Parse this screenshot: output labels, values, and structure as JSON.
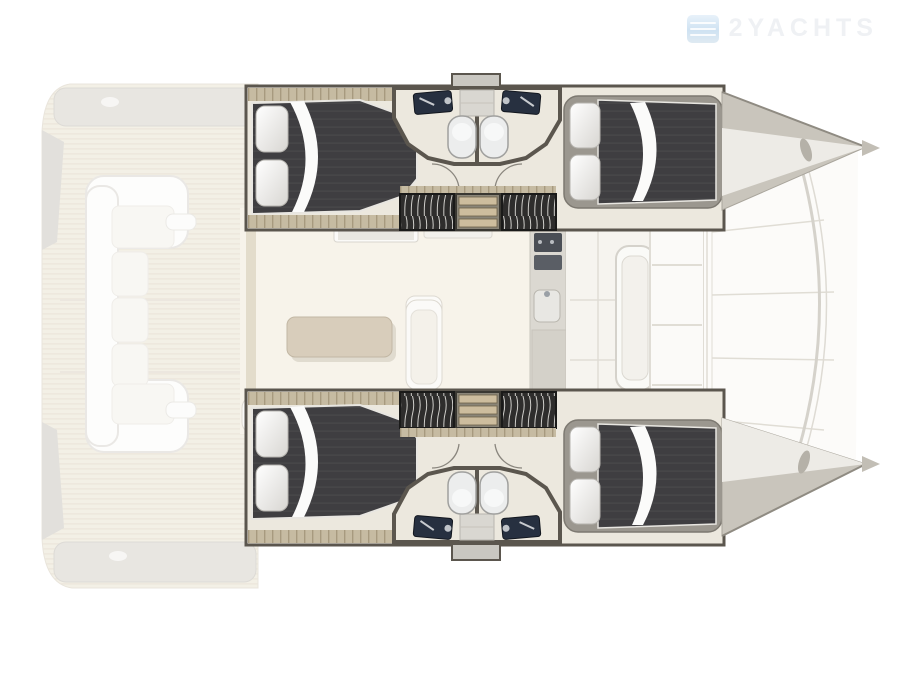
{
  "watermark": {
    "text": "2YACHTS",
    "icon": "yacht-logo-icon"
  },
  "plan": {
    "kind": "catamaran floor plan",
    "hulls": 2,
    "cabins": 4,
    "bathrooms": 4
  },
  "colors": {
    "page-bg": "#ffffff",
    "ghost-wood": "#ebe4d3",
    "deck-gray": "#d6d2ca",
    "hull-wall": "#5b564e",
    "bath-floor": "#ece8de",
    "bed-dark": "#3f3e41",
    "pillow": "#f7f6f4",
    "salon-floor": "#f7f3ea",
    "table-tan": "#d8cdbb",
    "sofa-white": "#f4f1ea",
    "counter-gray": "#dbd8d1",
    "sink-dark": "#273040",
    "toilet-white": "#eceded",
    "step-wood": "#cdbd9e",
    "hatch-dark": "#2e2d2c",
    "bow-gray": "#c9c5bc",
    "bow-light": "#edebe6",
    "tramp-white": "#fcfbf9",
    "seam": "#e0ddd5",
    "watermark-text": "#eff1f4",
    "watermark-blue": "#cfe2f2"
  }
}
